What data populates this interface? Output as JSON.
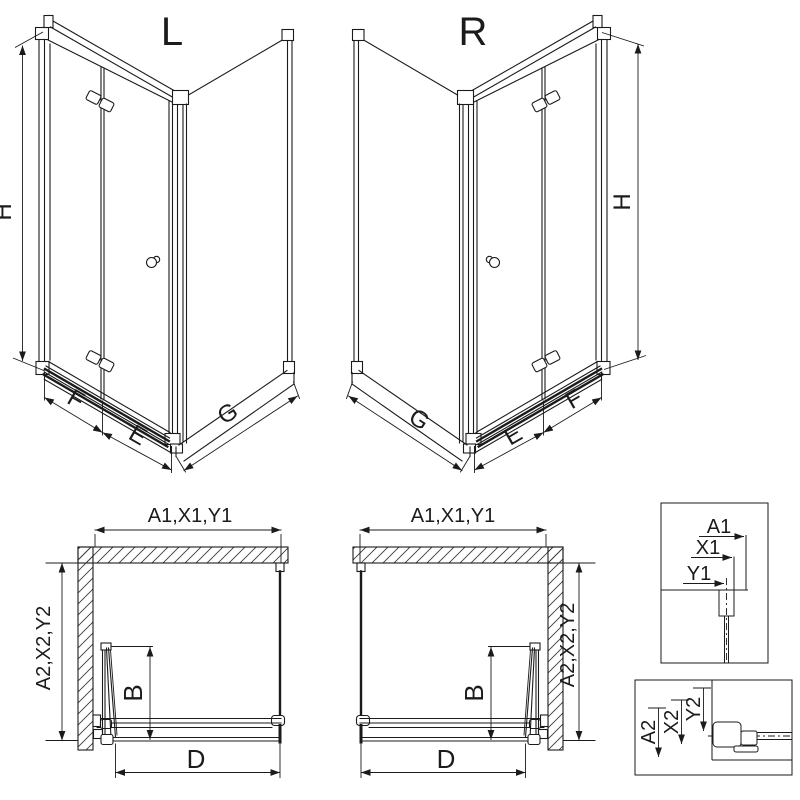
{
  "colors": {
    "background": "#ffffff",
    "line": "#1b1b1b"
  },
  "iso_views": {
    "left": {
      "variant": "L",
      "dim_h": "H",
      "dim_f": "F",
      "dim_e": "E",
      "dim_g": "G"
    },
    "right": {
      "variant": "R",
      "dim_h": "H",
      "dim_f": "F",
      "dim_e": "E",
      "dim_g": "G"
    }
  },
  "plan_views": {
    "left": {
      "dim_width": "A1,X1,Y1",
      "dim_depth": "A2,X2,Y2",
      "dim_fold": "B",
      "dim_entry": "D"
    },
    "right": {
      "dim_width": "A1,X1,Y1",
      "dim_depth": "A2,X2,Y2",
      "dim_fold": "B",
      "dim_entry": "D"
    }
  },
  "detail_views": {
    "top_profile": {
      "dims": [
        "A1",
        "X1",
        "Y1"
      ]
    },
    "bottom_profile": {
      "dims": [
        "A2",
        "X2",
        "Y2"
      ]
    }
  }
}
